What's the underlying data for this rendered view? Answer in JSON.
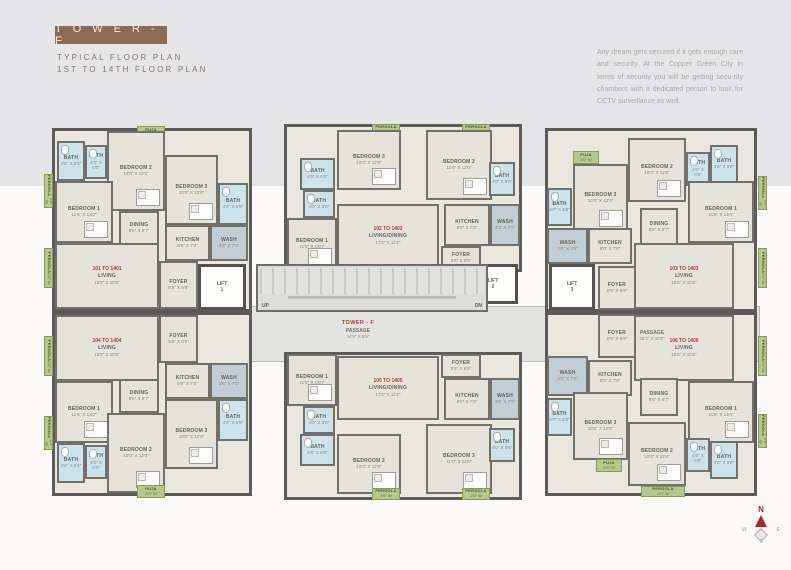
{
  "header": {
    "title": "T O W E R  -  F",
    "subtitle1": "TYPICAL  FLOOR  PLAN",
    "subtitle2": "1ST TO 14TH FLOOR PLAN",
    "description": "Any dream gets secured if it gets enough care and security. At the Copper Green City in terms of security you will be getting secu-rity chambers with a dedicated person to look for CCTV surveillance as well."
  },
  "colors": {
    "accent_brown": "#8a6c55",
    "wall": "#5c5b57",
    "floor": "#e6e3da",
    "bath": "#cde3ec",
    "green": "#b6c88e",
    "corridor": "#e3e3e1",
    "unit_red": "#b23c32"
  },
  "center": {
    "tower_label": "TOWER - F",
    "passage1": {
      "label": "PASSAGE",
      "dims": "44'9\" X 5'5\""
    },
    "passage2": {
      "label": "PASSAGE",
      "dims": "36'3\" X 10'0\""
    },
    "up": "UP",
    "dn": "DN"
  },
  "compass": {
    "n": "N",
    "e": "E",
    "s": "S",
    "w": "W"
  },
  "units": [
    {
      "id": "101",
      "x": 52,
      "y": 128,
      "w": 200,
      "h": 184
    },
    {
      "id": "102",
      "x": 284,
      "y": 124,
      "w": 238,
      "h": 148
    },
    {
      "id": "103",
      "x": 545,
      "y": 128,
      "w": 212,
      "h": 184
    },
    {
      "id": "104",
      "x": 52,
      "y": 312,
      "w": 200,
      "h": 184
    },
    {
      "id": "105",
      "x": 284,
      "y": 352,
      "w": 238,
      "h": 148
    },
    {
      "id": "106",
      "x": 545,
      "y": 312,
      "w": 212,
      "h": 184
    }
  ],
  "lifts": [
    {
      "id": "lift-1",
      "label": "LIFT",
      "num": "1",
      "x": 198,
      "y": 264,
      "w": 48,
      "h": 46
    },
    {
      "id": "lift-2",
      "label": "LIFT",
      "num": "2",
      "x": 468,
      "y": 264,
      "w": 50,
      "h": 40
    },
    {
      "id": "lift-3",
      "label": "LIFT",
      "num": "3",
      "x": 549,
      "y": 264,
      "w": 46,
      "h": 46
    }
  ],
  "rooms": [
    {
      "id": "u101-pergola-left-1",
      "n": "PERGOLA",
      "d": "2'0\" W",
      "t": "greenv",
      "x": 44,
      "y": 174,
      "w": 9,
      "h": 34
    },
    {
      "id": "u101-pergola-left-2",
      "n": "PERGOLA",
      "d": "2'0\" W",
      "t": "greenv",
      "x": 44,
      "y": 248,
      "w": 9,
      "h": 40
    },
    {
      "id": "u101-puja",
      "n": "PUJA",
      "d": "2'0\" W",
      "t": "green",
      "x": 137,
      "y": 126,
      "w": 28,
      "h": 13
    },
    {
      "id": "u101-bath-1",
      "n": "BATH",
      "d": "4'6\" X 6'6\"",
      "t": "bath",
      "x": 57,
      "y": 141,
      "w": 28,
      "h": 40
    },
    {
      "id": "u101-bath-2",
      "n": "BATH",
      "d": "4'0\" X 6'0\"",
      "t": "bath",
      "x": 85,
      "y": 145,
      "w": 22,
      "h": 34
    },
    {
      "id": "u101-bedroom-2",
      "n": "BEDROOM 2",
      "d": "10'0\" X 12'0\"",
      "t": "bed",
      "x": 107,
      "y": 131,
      "w": 58,
      "h": 80
    },
    {
      "id": "u101-bedroom-3",
      "n": "BEDROOM 3",
      "d": "10'0\" X 12'0\"",
      "t": "bed",
      "x": 165,
      "y": 155,
      "w": 53,
      "h": 70
    },
    {
      "id": "u101-bath-3",
      "n": "BATH",
      "d": "4'6\" X 6'6\"",
      "t": "bath",
      "x": 218,
      "y": 183,
      "w": 30,
      "h": 42
    },
    {
      "id": "u101-bedroom-1",
      "n": "BEDROOM 1",
      "d": "11'6\" X 13'0\"",
      "t": "bed",
      "x": 55,
      "y": 181,
      "w": 58,
      "h": 62
    },
    {
      "id": "u101-dining",
      "n": "DINING",
      "d": "8'6\" X 6'7\"",
      "t": "room",
      "x": 119,
      "y": 211,
      "w": 40,
      "h": 34
    },
    {
      "id": "u101-kitchen",
      "n": "KITCHEN",
      "d": "8'6\" X 7'0\"",
      "t": "room",
      "x": 165,
      "y": 225,
      "w": 45,
      "h": 36
    },
    {
      "id": "u101-wash",
      "n": "WASH",
      "d": "3'6\" X 7'0\"",
      "t": "wash",
      "x": 210,
      "y": 225,
      "w": 38,
      "h": 36
    },
    {
      "id": "u101-living",
      "n": "LIVING",
      "d": "15'6\" X 10'6\"",
      "t": "room",
      "x": 55,
      "y": 243,
      "w": 104,
      "h": 66,
      "red": "101 TO 1401"
    },
    {
      "id": "u101-foyer",
      "n": "FOYER",
      "d": "5'6\" X 6'9\"",
      "t": "room",
      "x": 159,
      "y": 261,
      "w": 39,
      "h": 48
    },
    {
      "id": "u102-pergola-1",
      "n": "PERGOLA",
      "d": "2'0\" W",
      "t": "green",
      "x": 372,
      "y": 124,
      "w": 28,
      "h": 12
    },
    {
      "id": "u102-pergola-2",
      "n": "PERGOLA",
      "d": "2'0\" W",
      "t": "green",
      "x": 462,
      "y": 124,
      "w": 28,
      "h": 12
    },
    {
      "id": "u102-bedroom-3",
      "n": "BEDROOM 3",
      "d": "10'0\" X 12'0\"",
      "t": "bed",
      "x": 337,
      "y": 130,
      "w": 64,
      "h": 60
    },
    {
      "id": "u102-bedroom-2",
      "n": "BEDROOM 2",
      "d": "11'0\" X 12'0\"",
      "t": "bed",
      "x": 426,
      "y": 130,
      "w": 66,
      "h": 70
    },
    {
      "id": "u102-bath-1",
      "n": "BATH",
      "d": "4'0\" X 6'0\"",
      "t": "bath",
      "x": 300,
      "y": 158,
      "w": 35,
      "h": 32
    },
    {
      "id": "u102-bath-2",
      "n": "BATH",
      "d": "4'0\" X 6'0\"",
      "t": "bath",
      "x": 303,
      "y": 190,
      "w": 32,
      "h": 28
    },
    {
      "id": "u102-bedroom-1",
      "n": "BEDROOM 1",
      "d": "11'6\" X 13'0\"",
      "t": "bed",
      "x": 287,
      "y": 218,
      "w": 50,
      "h": 52
    },
    {
      "id": "u102-living-dining",
      "n": "LIVING/DINING",
      "d": "17'6\" X 11'2\"",
      "t": "room",
      "x": 337,
      "y": 204,
      "w": 102,
      "h": 64,
      "red": "102 TO 1402"
    },
    {
      "id": "u102-kitchen",
      "n": "KITCHEN",
      "d": "8'6\" X 7'0\"",
      "t": "room",
      "x": 444,
      "y": 204,
      "w": 46,
      "h": 42
    },
    {
      "id": "u102-wash",
      "n": "WASH",
      "d": "3'0\" X 7'0\"",
      "t": "wash",
      "x": 490,
      "y": 204,
      "w": 30,
      "h": 42
    },
    {
      "id": "u102-bath-3",
      "n": "BATH",
      "d": "4'0\" X 6'0\"",
      "t": "bath",
      "x": 489,
      "y": 162,
      "w": 26,
      "h": 34
    },
    {
      "id": "u102-foyer",
      "n": "FOYER",
      "d": "5'6\" X 6'9\"",
      "t": "room",
      "x": 441,
      "y": 246,
      "w": 40,
      "h": 24
    },
    {
      "id": "u103-puja",
      "n": "PUJA",
      "d": "2'0\" W",
      "t": "green",
      "x": 573,
      "y": 151,
      "w": 26,
      "h": 13
    },
    {
      "id": "u103-pergola-right-1",
      "n": "PERGOLA",
      "d": "2'0\" W",
      "t": "greenv",
      "x": 758,
      "y": 176,
      "w": 9,
      "h": 34
    },
    {
      "id": "u103-pergola-right-2",
      "n": "PERGOLA",
      "d": "2'0\" W",
      "t": "greenv",
      "x": 758,
      "y": 248,
      "w": 9,
      "h": 40
    },
    {
      "id": "u103-bedroom-3",
      "n": "BEDROOM 3",
      "d": "10'0\" X 12'0\"",
      "t": "bed",
      "x": 573,
      "y": 164,
      "w": 55,
      "h": 68
    },
    {
      "id": "u103-bedroom-2",
      "n": "BEDROOM 2",
      "d": "10'0\" X 12'0\"",
      "t": "bed",
      "x": 628,
      "y": 138,
      "w": 58,
      "h": 64
    },
    {
      "id": "u103-bath-1",
      "n": "BATH",
      "d": "4'0\" X 6'0\"",
      "t": "bath",
      "x": 686,
      "y": 152,
      "w": 24,
      "h": 34
    },
    {
      "id": "u103-bath-2",
      "n": "BATH",
      "d": "4'6\" X 6'6\"",
      "t": "bath",
      "x": 710,
      "y": 145,
      "w": 28,
      "h": 38
    },
    {
      "id": "u103-bath-3",
      "n": "BATH",
      "d": "4'0\" X 6'6\"",
      "t": "bath",
      "x": 547,
      "y": 188,
      "w": 25,
      "h": 38
    },
    {
      "id": "u103-bedroom-1",
      "n": "BEDROOM 1",
      "d": "11'6\" X 13'0\"",
      "t": "bed",
      "x": 688,
      "y": 181,
      "w": 66,
      "h": 62
    },
    {
      "id": "u103-dining",
      "n": "DINING",
      "d": "8'6\" X 6'7\"",
      "t": "room",
      "x": 640,
      "y": 208,
      "w": 38,
      "h": 38
    },
    {
      "id": "u103-kitchen",
      "n": "KITCHEN",
      "d": "8'0\" X 7'0\"",
      "t": "room",
      "x": 588,
      "y": 228,
      "w": 44,
      "h": 36
    },
    {
      "id": "u103-wash",
      "n": "WASH",
      "d": "3'0\" X 7'0\"",
      "t": "wash",
      "x": 547,
      "y": 228,
      "w": 41,
      "h": 36
    },
    {
      "id": "u103-living",
      "n": "LIVING",
      "d": "15'6\" X 10'6\"",
      "t": "room",
      "x": 634,
      "y": 243,
      "w": 100,
      "h": 66,
      "red": "103 TO 1403"
    },
    {
      "id": "u103-foyer",
      "n": "FOYER",
      "d": "5'6\" X 6'9\"",
      "t": "room",
      "x": 598,
      "y": 266,
      "w": 38,
      "h": 44
    },
    {
      "id": "core-foyer",
      "n": "FOYER",
      "d": "5'6\" X 6'9\"",
      "t": "room",
      "x": 438,
      "y": 270,
      "w": 30,
      "h": 34
    },
    {
      "id": "u104-pergola-left-1",
      "n": "PERGOLA",
      "d": "2'0\" W",
      "t": "greenv",
      "x": 44,
      "y": 336,
      "w": 9,
      "h": 40
    },
    {
      "id": "u104-pergola-left-2",
      "n": "PERGOLA",
      "d": "2'0\" W",
      "t": "greenv",
      "x": 44,
      "y": 416,
      "w": 9,
      "h": 34
    },
    {
      "id": "u104-living",
      "n": "LIVING",
      "d": "15'6\" X 10'6\"",
      "t": "room",
      "x": 55,
      "y": 315,
      "w": 104,
      "h": 66,
      "red": "104 TO 1404"
    },
    {
      "id": "u104-foyer",
      "n": "FOYER",
      "d": "5'6\" X 6'9\"",
      "t": "room",
      "x": 159,
      "y": 315,
      "w": 39,
      "h": 48
    },
    {
      "id": "u104-kitchen",
      "n": "KITCHEN",
      "d": "8'6\" X 7'0\"",
      "t": "room",
      "x": 165,
      "y": 363,
      "w": 45,
      "h": 36
    },
    {
      "id": "u104-wash",
      "n": "WASH",
      "d": "3'6\" X 7'0\"",
      "t": "wash",
      "x": 210,
      "y": 363,
      "w": 38,
      "h": 36
    },
    {
      "id": "u104-dining",
      "n": "DINING",
      "d": "8'6\" X 6'7\"",
      "t": "room",
      "x": 119,
      "y": 379,
      "w": 40,
      "h": 34
    },
    {
      "id": "u104-bedroom-1",
      "n": "BEDROOM 1",
      "d": "11'6\" X 13'0\"",
      "t": "bed",
      "x": 55,
      "y": 381,
      "w": 58,
      "h": 62
    },
    {
      "id": "u104-bedroom-3",
      "n": "BEDROOM 3",
      "d": "10'0\" X 12'0\"",
      "t": "bed",
      "x": 165,
      "y": 399,
      "w": 53,
      "h": 70
    },
    {
      "id": "u104-bath-3",
      "n": "BATH",
      "d": "4'6\" X 6'6\"",
      "t": "bath",
      "x": 218,
      "y": 399,
      "w": 30,
      "h": 42
    },
    {
      "id": "u104-bedroom-2",
      "n": "BEDROOM 2",
      "d": "10'0\" X 12'0\"",
      "t": "bed",
      "x": 107,
      "y": 413,
      "w": 58,
      "h": 80
    },
    {
      "id": "u104-bath-1",
      "n": "BATH",
      "d": "4'6\" X 6'6\"",
      "t": "bath",
      "x": 57,
      "y": 443,
      "w": 28,
      "h": 40
    },
    {
      "id": "u104-bath-2",
      "n": "BATH",
      "d": "4'0\" X 6'0\"",
      "t": "bath",
      "x": 85,
      "y": 445,
      "w": 22,
      "h": 34
    },
    {
      "id": "u104-puja",
      "n": "PUJA",
      "d": "2'0\" W",
      "t": "green",
      "x": 137,
      "y": 485,
      "w": 28,
      "h": 13
    },
    {
      "id": "u105-bedroom-1",
      "n": "BEDROOM 1",
      "d": "11'6\" X 13'0\"",
      "t": "bed",
      "x": 287,
      "y": 354,
      "w": 50,
      "h": 52
    },
    {
      "id": "u105-living-dining",
      "n": "LIVING/DINING",
      "d": "17'6\" X 11'2\"",
      "t": "room",
      "x": 337,
      "y": 356,
      "w": 102,
      "h": 64,
      "red": "105 TO 1405"
    },
    {
      "id": "u105-foyer",
      "n": "FOYER",
      "d": "5'6\" X 6'9\"",
      "t": "room",
      "x": 441,
      "y": 354,
      "w": 40,
      "h": 24
    },
    {
      "id": "u105-kitchen",
      "n": "KITCHEN",
      "d": "8'6\" X 7'0\"",
      "t": "room",
      "x": 444,
      "y": 378,
      "w": 46,
      "h": 42
    },
    {
      "id": "u105-wash",
      "n": "WASH",
      "d": "3'6\" X 7'0\"",
      "t": "wash",
      "x": 490,
      "y": 378,
      "w": 30,
      "h": 42
    },
    {
      "id": "u105-bath-2",
      "n": "BATH",
      "d": "4'0\" X 6'0\"",
      "t": "bath",
      "x": 303,
      "y": 406,
      "w": 32,
      "h": 28
    },
    {
      "id": "u105-bath-1",
      "n": "BATH",
      "d": "4'0\" X 6'0\"",
      "t": "bath",
      "x": 300,
      "y": 434,
      "w": 35,
      "h": 32
    },
    {
      "id": "u105-bedroom-2",
      "n": "BEDROOM 2",
      "d": "10'0\" X 12'0\"",
      "t": "bed",
      "x": 337,
      "y": 434,
      "w": 64,
      "h": 60
    },
    {
      "id": "u105-bedroom-3",
      "n": "BEDROOM 3",
      "d": "11'0\" X 12'0\"",
      "t": "bed",
      "x": 426,
      "y": 424,
      "w": 66,
      "h": 70
    },
    {
      "id": "u105-bath-3",
      "n": "BATH",
      "d": "4'0\" X 6'6\"",
      "t": "bath",
      "x": 489,
      "y": 428,
      "w": 26,
      "h": 34
    },
    {
      "id": "u105-pergola-1",
      "n": "PERGOLA",
      "d": "2'0\" W",
      "t": "green",
      "x": 372,
      "y": 488,
      "w": 28,
      "h": 12
    },
    {
      "id": "u105-pergola-2",
      "n": "PERGOLA",
      "d": "2'0\" W",
      "t": "green",
      "x": 462,
      "y": 488,
      "w": 28,
      "h": 12
    },
    {
      "id": "u106-pergola-right-1",
      "n": "PERGOLA",
      "d": "2'0\" W",
      "t": "greenv",
      "x": 758,
      "y": 336,
      "w": 9,
      "h": 40
    },
    {
      "id": "u106-pergola-right-2",
      "n": "PERGOLA",
      "d": "2'0\" W",
      "t": "greenv",
      "x": 758,
      "y": 414,
      "w": 9,
      "h": 34
    },
    {
      "id": "u106-living",
      "n": "LIVING",
      "d": "15'6\" X 10'6\"",
      "t": "room",
      "x": 634,
      "y": 315,
      "w": 100,
      "h": 66,
      "red": "106 TO 1406"
    },
    {
      "id": "u106-foyer",
      "n": "FOYER",
      "d": "5'6\" X 6'9\"",
      "t": "room",
      "x": 598,
      "y": 314,
      "w": 38,
      "h": 44
    },
    {
      "id": "u106-kitchen",
      "n": "KITCHEN",
      "d": "8'0\" X 7'0\"",
      "t": "room",
      "x": 588,
      "y": 360,
      "w": 44,
      "h": 36
    },
    {
      "id": "u106-wash",
      "n": "WASH",
      "d": "3'0\" X 7'0\"",
      "t": "wash",
      "x": 547,
      "y": 356,
      "w": 41,
      "h": 40
    },
    {
      "id": "u106-dining",
      "n": "DINING",
      "d": "8'6\" X 6'7\"",
      "t": "room",
      "x": 640,
      "y": 378,
      "w": 38,
      "h": 38
    },
    {
      "id": "u106-bedroom-3",
      "n": "BEDROOM 3",
      "d": "10'0\" X 12'0\"",
      "t": "bed",
      "x": 573,
      "y": 392,
      "w": 55,
      "h": 68
    },
    {
      "id": "u106-bath-3",
      "n": "BATH",
      "d": "4'0\" X 6'6\"",
      "t": "bath",
      "x": 547,
      "y": 398,
      "w": 25,
      "h": 38
    },
    {
      "id": "u106-bedroom-1",
      "n": "BEDROOM 1",
      "d": "11'6\" X 13'0\"",
      "t": "bed",
      "x": 688,
      "y": 381,
      "w": 66,
      "h": 62
    },
    {
      "id": "u106-bedroom-2",
      "n": "BEDROOM 2",
      "d": "10'0\" X 12'0\"",
      "t": "bed",
      "x": 628,
      "y": 422,
      "w": 58,
      "h": 64
    },
    {
      "id": "u106-bath-1",
      "n": "BATH",
      "d": "4'0\" X 6'6\"",
      "t": "bath",
      "x": 686,
      "y": 438,
      "w": 24,
      "h": 34
    },
    {
      "id": "u106-bath-2",
      "n": "BATH",
      "d": "4'0\" X 6'6\"",
      "t": "bath",
      "x": 710,
      "y": 441,
      "w": 28,
      "h": 38
    },
    {
      "id": "u106-puja",
      "n": "PUJA",
      "d": "2'0\" W",
      "t": "green",
      "x": 596,
      "y": 459,
      "w": 26,
      "h": 13
    },
    {
      "id": "u106-pergola-bottom",
      "n": "PERGOLA",
      "d": "2'0\" W",
      "t": "green",
      "x": 641,
      "y": 486,
      "w": 44,
      "h": 11
    }
  ]
}
